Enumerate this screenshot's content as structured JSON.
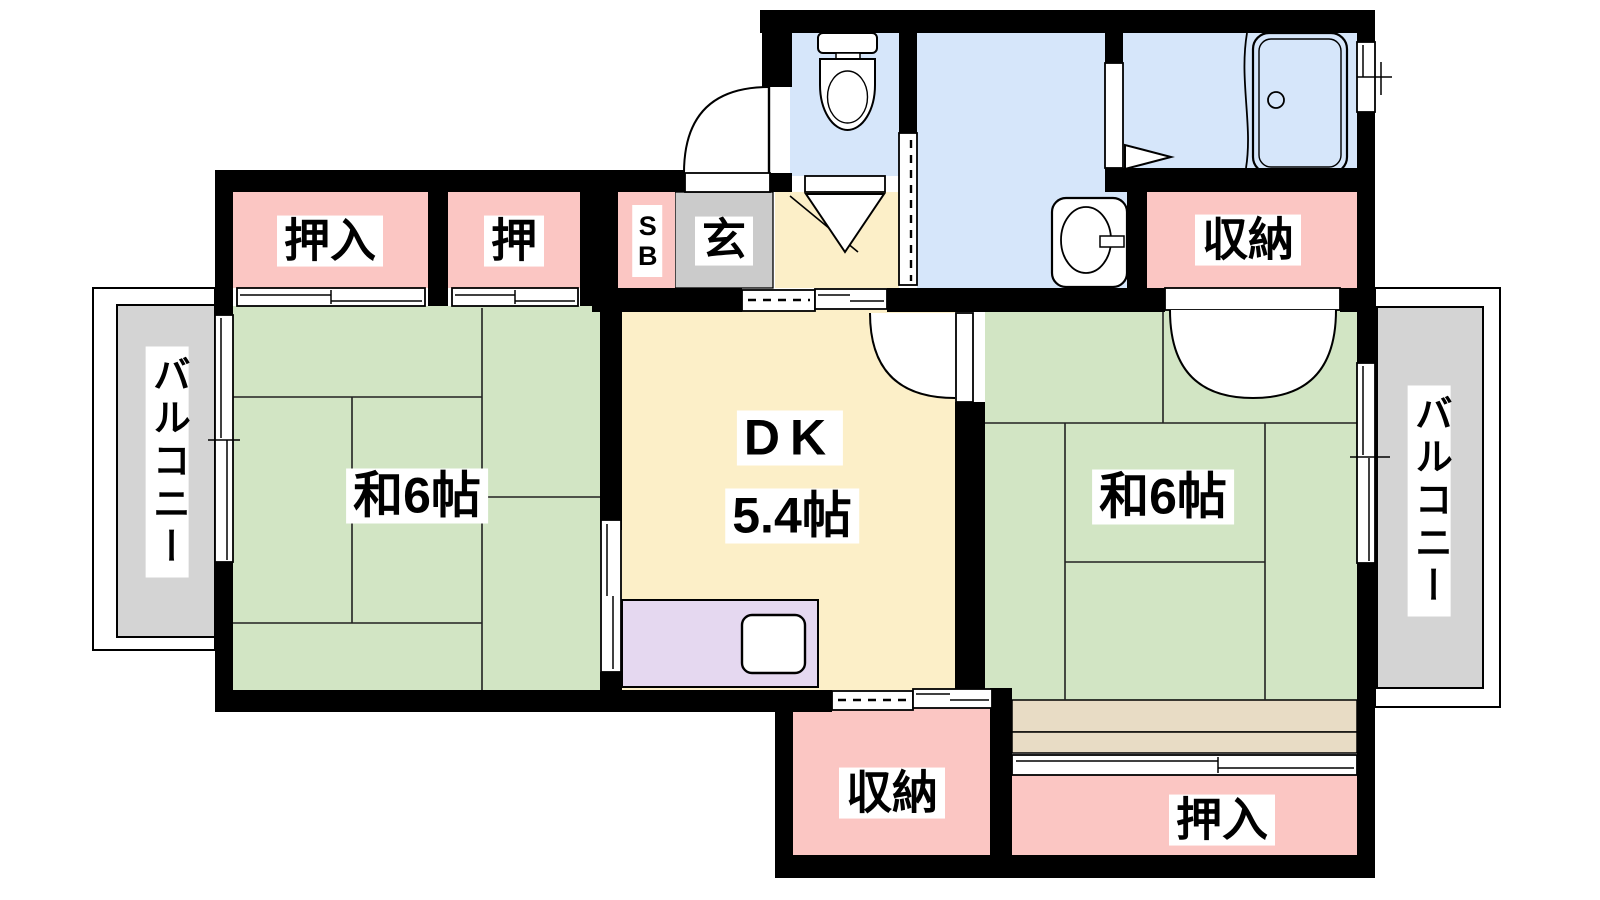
{
  "labels": {
    "closet_nw": "押入",
    "closet_n": "押",
    "shoe_box": "SB",
    "genkan": "玄",
    "room_west": "和6帖",
    "dk_title": "DK",
    "dk_size": "5.4帖",
    "room_east": "和6帖",
    "storage_ne": "収納",
    "storage_s": "収納",
    "closet_se": "押入",
    "balcony_west": "バルコニー",
    "balcony_east": "バルコニー"
  },
  "palette": {
    "wall": "#000000",
    "tatami_room": "#d2e5c4",
    "dk_floor": "#fcefc8",
    "closet": "#fbc6c3",
    "water_room": "#d6e6fa",
    "kitchen_counter": "#e5d8f0",
    "genkan_floor": "#cbcbcb",
    "balcony": "#d4d4d4",
    "wood_edge": "#e8dcc5"
  }
}
